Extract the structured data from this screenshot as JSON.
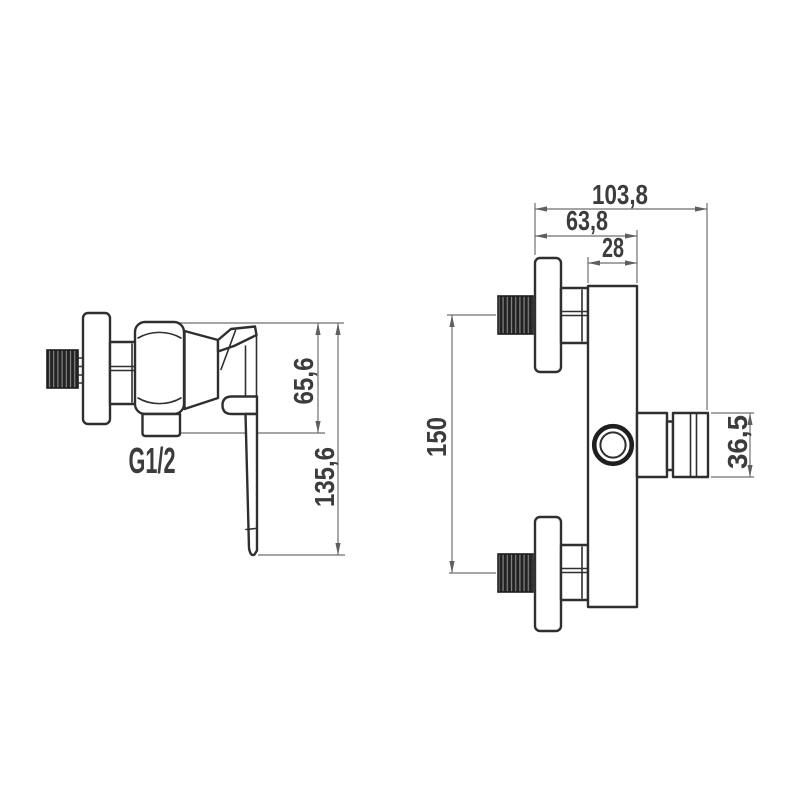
{
  "drawing": {
    "side_view": {
      "thread_label": "G1/2",
      "dimensions": {
        "body_height": "65,6",
        "total_height": "135,6"
      }
    },
    "front_view": {
      "dimensions": {
        "overall_depth": "103,8",
        "body_depth": "63,8",
        "body_width": "28",
        "inlet_spacing": "150",
        "outlet_height": "36,5"
      }
    },
    "colors": {
      "outline": "#2f2f2f",
      "dimension_lines": "#6f6f6f",
      "text": "#3c3c3c",
      "thread_fill": "#222222",
      "background": "#ffffff"
    }
  }
}
